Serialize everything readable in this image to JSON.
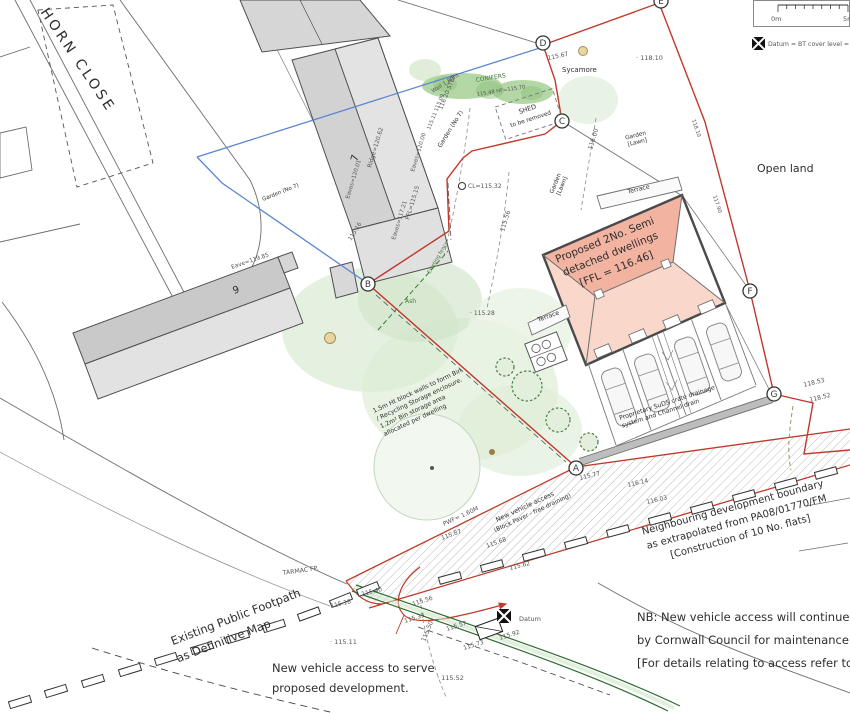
{
  "colors": {
    "boundary_red": "#c0392b",
    "water_blue": "#5b86d2",
    "roof_pink_dark": "#f2b3a1",
    "roof_pink_light": "#fad7cb",
    "veg_green": "#d9ead1",
    "hedge_green": "#abd49b",
    "kerb_green": "#2f6b2f",
    "building_grey": "#d6d6d6"
  },
  "t": {
    "horn_close": "HORN CLOSE",
    "open_land": "Open land",
    "sycamore": "Sycamore",
    "conifers": "CONIFERS",
    "shed1": "SHED",
    "shed2": "to be removed",
    "garden_no7_a": "Garden (No 7)",
    "garden_no7_b": "Garden (No 7)",
    "garden_lawn1a": "Garden",
    "garden_lawn1b": "[Lawn]",
    "garden_lawn2a": "Garden",
    "garden_lawn2b": "[Lawn]",
    "terrace_n": "Terrace",
    "terrace_w": "Terrace",
    "no7": "7",
    "no9": "9",
    "eave9": "Eave=119.85",
    "ridge7": "Ridge=120.62",
    "eaves7a": "Eaves=120.01",
    "eaves7b": "Eaves=120.00",
    "ffl7": "FFL=115.15",
    "eaves7c": "Eaves=117.21",
    "wall_ht": "Wall 1.80ht",
    "step": "116.20 STEP",
    "cl": "CL=115.32",
    "proposed1": "Proposed 2No. Semi",
    "proposed2": "detached dwellings",
    "proposed3": "[FFL = 116.46]",
    "suds1": "Proprietary SuDS crate drainage",
    "suds2": "system and Channel drain",
    "bin1": "1.5m Ht block walls to form Bin",
    "bin2": "/ Recycling Storage enclosure.",
    "bin3": "1.2m² Bin storage area",
    "bin4": "allocated per dwelling",
    "ash": "Ash",
    "exfence": "Existing fence",
    "nva1": "New vehicle access",
    "nva2": "(Block Paver - free draining)",
    "pwf": "PWF= 1.60M",
    "tarmac": "TARMAC FP.",
    "footpath1": "Existing Public Footpath",
    "footpath2": "as Definitive Map",
    "serve1": "New vehicle access to serve",
    "serve2": "proposed development.",
    "neigh1": "Neighbouring development boundary",
    "neigh2": "as extrapolated from PA08/01770/FM",
    "neigh3": "[Construction of 10 No. flats]",
    "nb1": "NB: New vehicle access will continue to be",
    "nb2": "by Cornwall Council for maintenance of the",
    "nb3": "[For details relating to access refer to dra",
    "datum": "Datum",
    "datum_note": "Datum = BT cover level =",
    "scale0": "0m",
    "scale5": "5m"
  },
  "v": {
    "l115_67": "115.67",
    "l118_10": "· 118.10",
    "l115_48": "115.48  HF=115.70",
    "l115_28": "· 115.28",
    "l115_16": "115.16",
    "l115_11a": "115.11  115.09",
    "l116_00": "116.00",
    "l115_56c": "115.56",
    "l115_50": "115.50",
    "l115_77": "115.77",
    "l115_87": "115.87",
    "l115_68": "115.68",
    "l115_62": "115.62",
    "l116_14": "116.14",
    "l116_03": "116.03",
    "l115_40": "115.40",
    "l115_18": "115.18",
    "l115_56": "115.56",
    "l115_33": "115.33",
    "l115_57": "115.57",
    "l115_73": "115.73",
    "l115_92": "115.92",
    "l115_11": "· 115.11",
    "l115_52": "· 115.52",
    "l118_53": "118.53",
    "l118_52": "118.52",
    "r1": "118.10",
    "r2": "117.90"
  },
  "m": {
    "a": "A",
    "b": "B",
    "c": "C",
    "d": "D",
    "e": "E",
    "f": "F",
    "g": "G"
  }
}
